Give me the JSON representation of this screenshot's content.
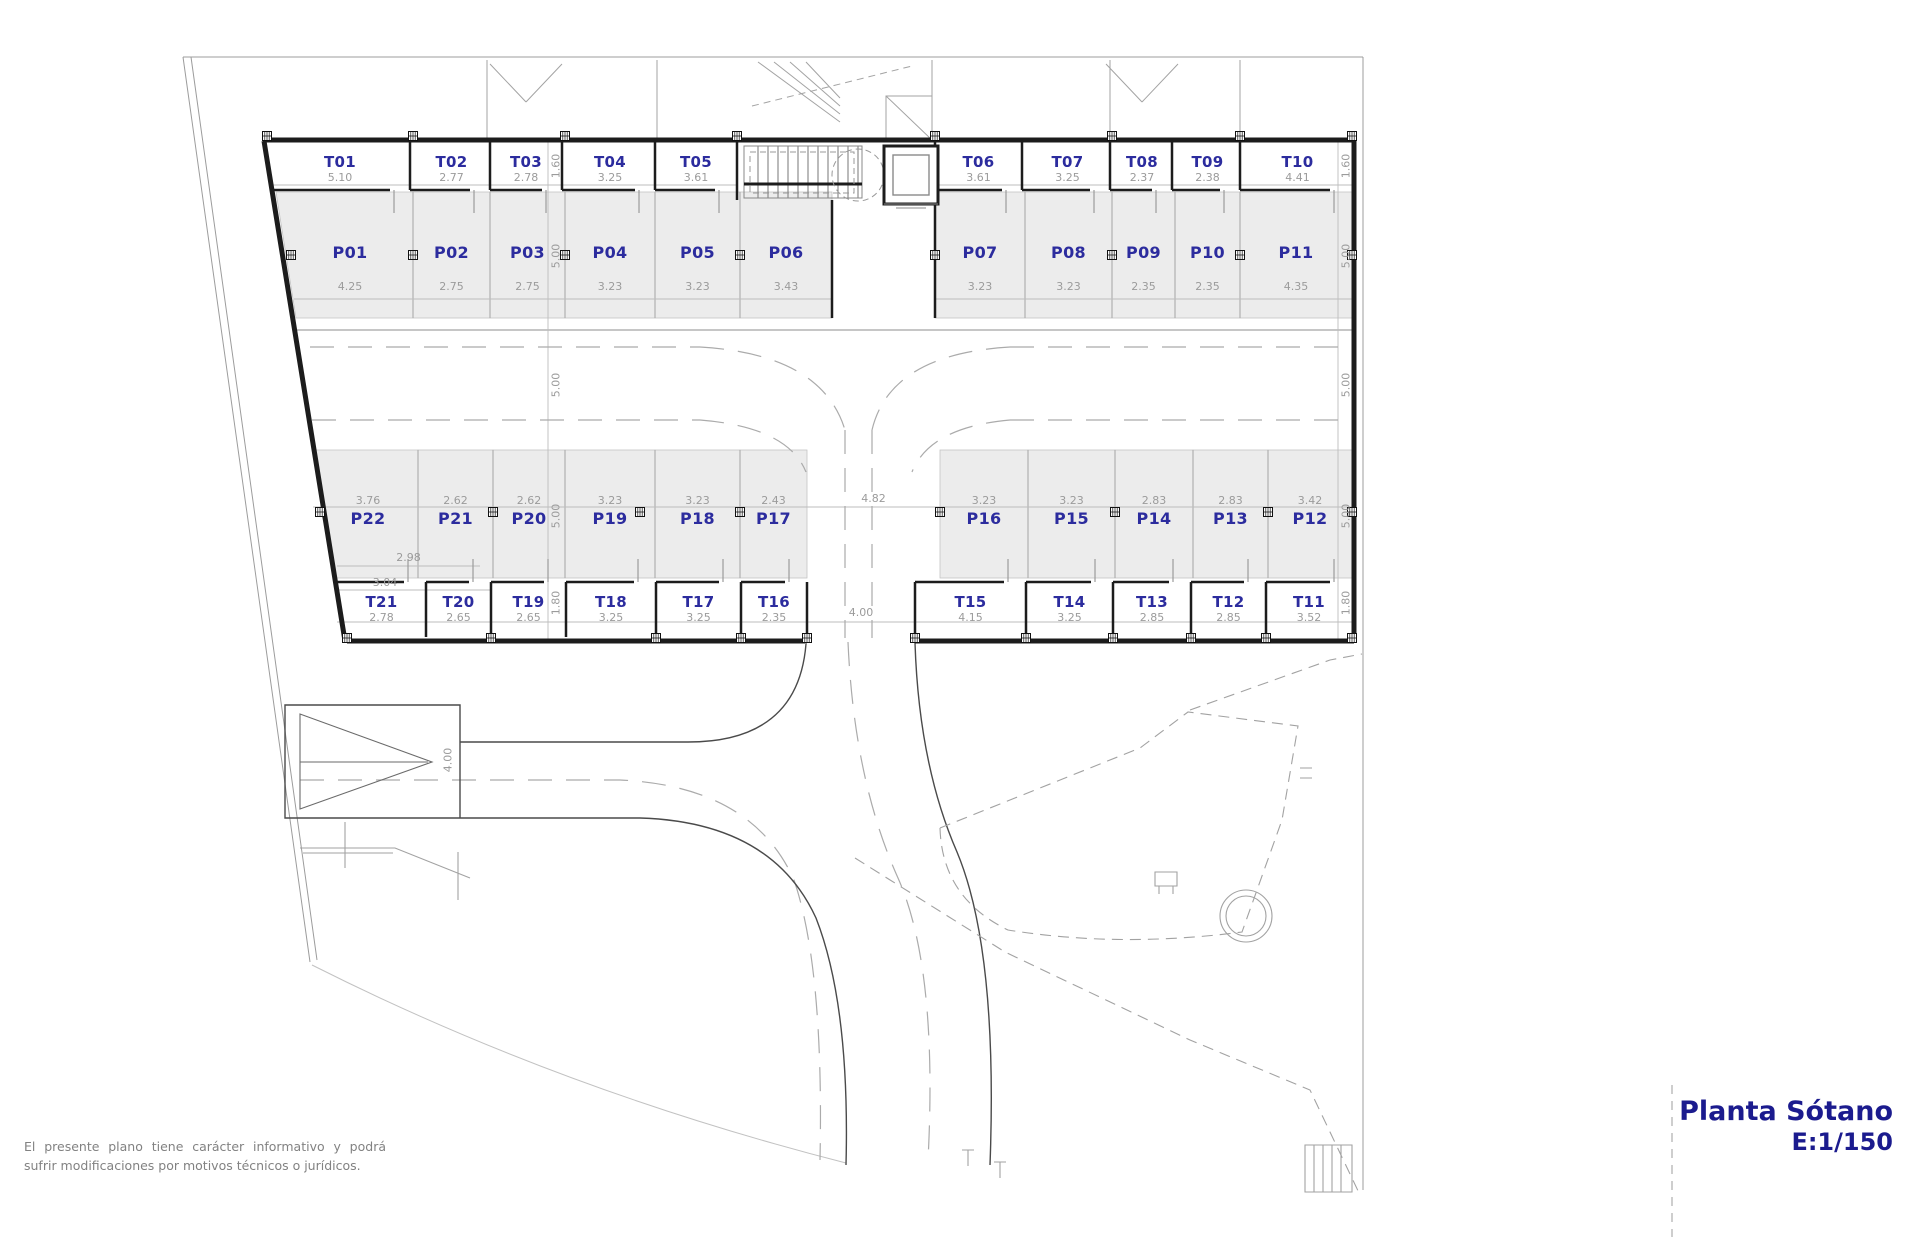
{
  "title": {
    "name": "Planta Sótano",
    "scale": "E:1/150"
  },
  "disclaimer": "El presente plano tiene carácter informativo y podrá sufrir modificaciones por motivos técnicos o jurídicos.",
  "colors": {
    "label_blue": "#2c2c9e",
    "title_blue": "#1b1b8e",
    "dim_gray": "#9b9b9b",
    "stall_fill": "#ececec",
    "wall_black": "#1c1c1c"
  },
  "storage_top": [
    {
      "label": "T01",
      "dim": "5.10"
    },
    {
      "label": "T02",
      "dim": "2.77"
    },
    {
      "label": "T03",
      "dim": "2.78"
    },
    {
      "label": "T04",
      "dim": "3.25"
    },
    {
      "label": "T05",
      "dim": "3.61"
    },
    {
      "label": "T06",
      "dim": "3.61"
    },
    {
      "label": "T07",
      "dim": "3.25"
    },
    {
      "label": "T08",
      "dim": "2.37"
    },
    {
      "label": "T09",
      "dim": "2.38"
    },
    {
      "label": "T10",
      "dim": "4.41"
    }
  ],
  "parking_top": [
    {
      "label": "P01",
      "dim": "4.25"
    },
    {
      "label": "P02",
      "dim": "2.75"
    },
    {
      "label": "P03",
      "dim": "2.75"
    },
    {
      "label": "P04",
      "dim": "3.23"
    },
    {
      "label": "P05",
      "dim": "3.23"
    },
    {
      "label": "P06",
      "dim": "3.43"
    },
    {
      "label": "P07",
      "dim": "3.23"
    },
    {
      "label": "P08",
      "dim": "3.23"
    },
    {
      "label": "P09",
      "dim": "2.35"
    },
    {
      "label": "P10",
      "dim": "2.35"
    },
    {
      "label": "P11",
      "dim": "4.35"
    }
  ],
  "parking_bottom": [
    {
      "label": "P22",
      "dim": "3.76"
    },
    {
      "label": "P21",
      "dim": "2.62"
    },
    {
      "label": "P20",
      "dim": "2.62"
    },
    {
      "label": "P19",
      "dim": "3.23"
    },
    {
      "label": "P18",
      "dim": "3.23"
    },
    {
      "label": "P17",
      "dim": "2.43"
    },
    {
      "label": "P16",
      "dim": "3.23"
    },
    {
      "label": "P15",
      "dim": "3.23"
    },
    {
      "label": "P14",
      "dim": "2.83"
    },
    {
      "label": "P13",
      "dim": "2.83"
    },
    {
      "label": "P12",
      "dim": "3.42"
    }
  ],
  "storage_bottom": [
    {
      "label": "T21",
      "dim": "2.78"
    },
    {
      "label": "T20",
      "dim": "2.65"
    },
    {
      "label": "T19",
      "dim": "2.65"
    },
    {
      "label": "T18",
      "dim": "3.25"
    },
    {
      "label": "T17",
      "dim": "3.25"
    },
    {
      "label": "T16",
      "dim": "2.35"
    },
    {
      "label": "T15",
      "dim": "4.15"
    },
    {
      "label": "T14",
      "dim": "3.25"
    },
    {
      "label": "T13",
      "dim": "2.85"
    },
    {
      "label": "T12",
      "dim": "2.85"
    },
    {
      "label": "T11",
      "dim": "3.52"
    }
  ],
  "chain_dims": {
    "left": [
      "1.60",
      "5.00",
      "5.00",
      "5.00",
      "1.80"
    ],
    "right": [
      "1.60",
      "5.00",
      "5.00",
      "5.00",
      "1.80"
    ]
  },
  "extra_dims": {
    "ramp_width": "4.00",
    "opening_width": "4.00",
    "aisle_gap": "4.82",
    "p22_inner": "2.98",
    "t21_outer": "3.04"
  }
}
